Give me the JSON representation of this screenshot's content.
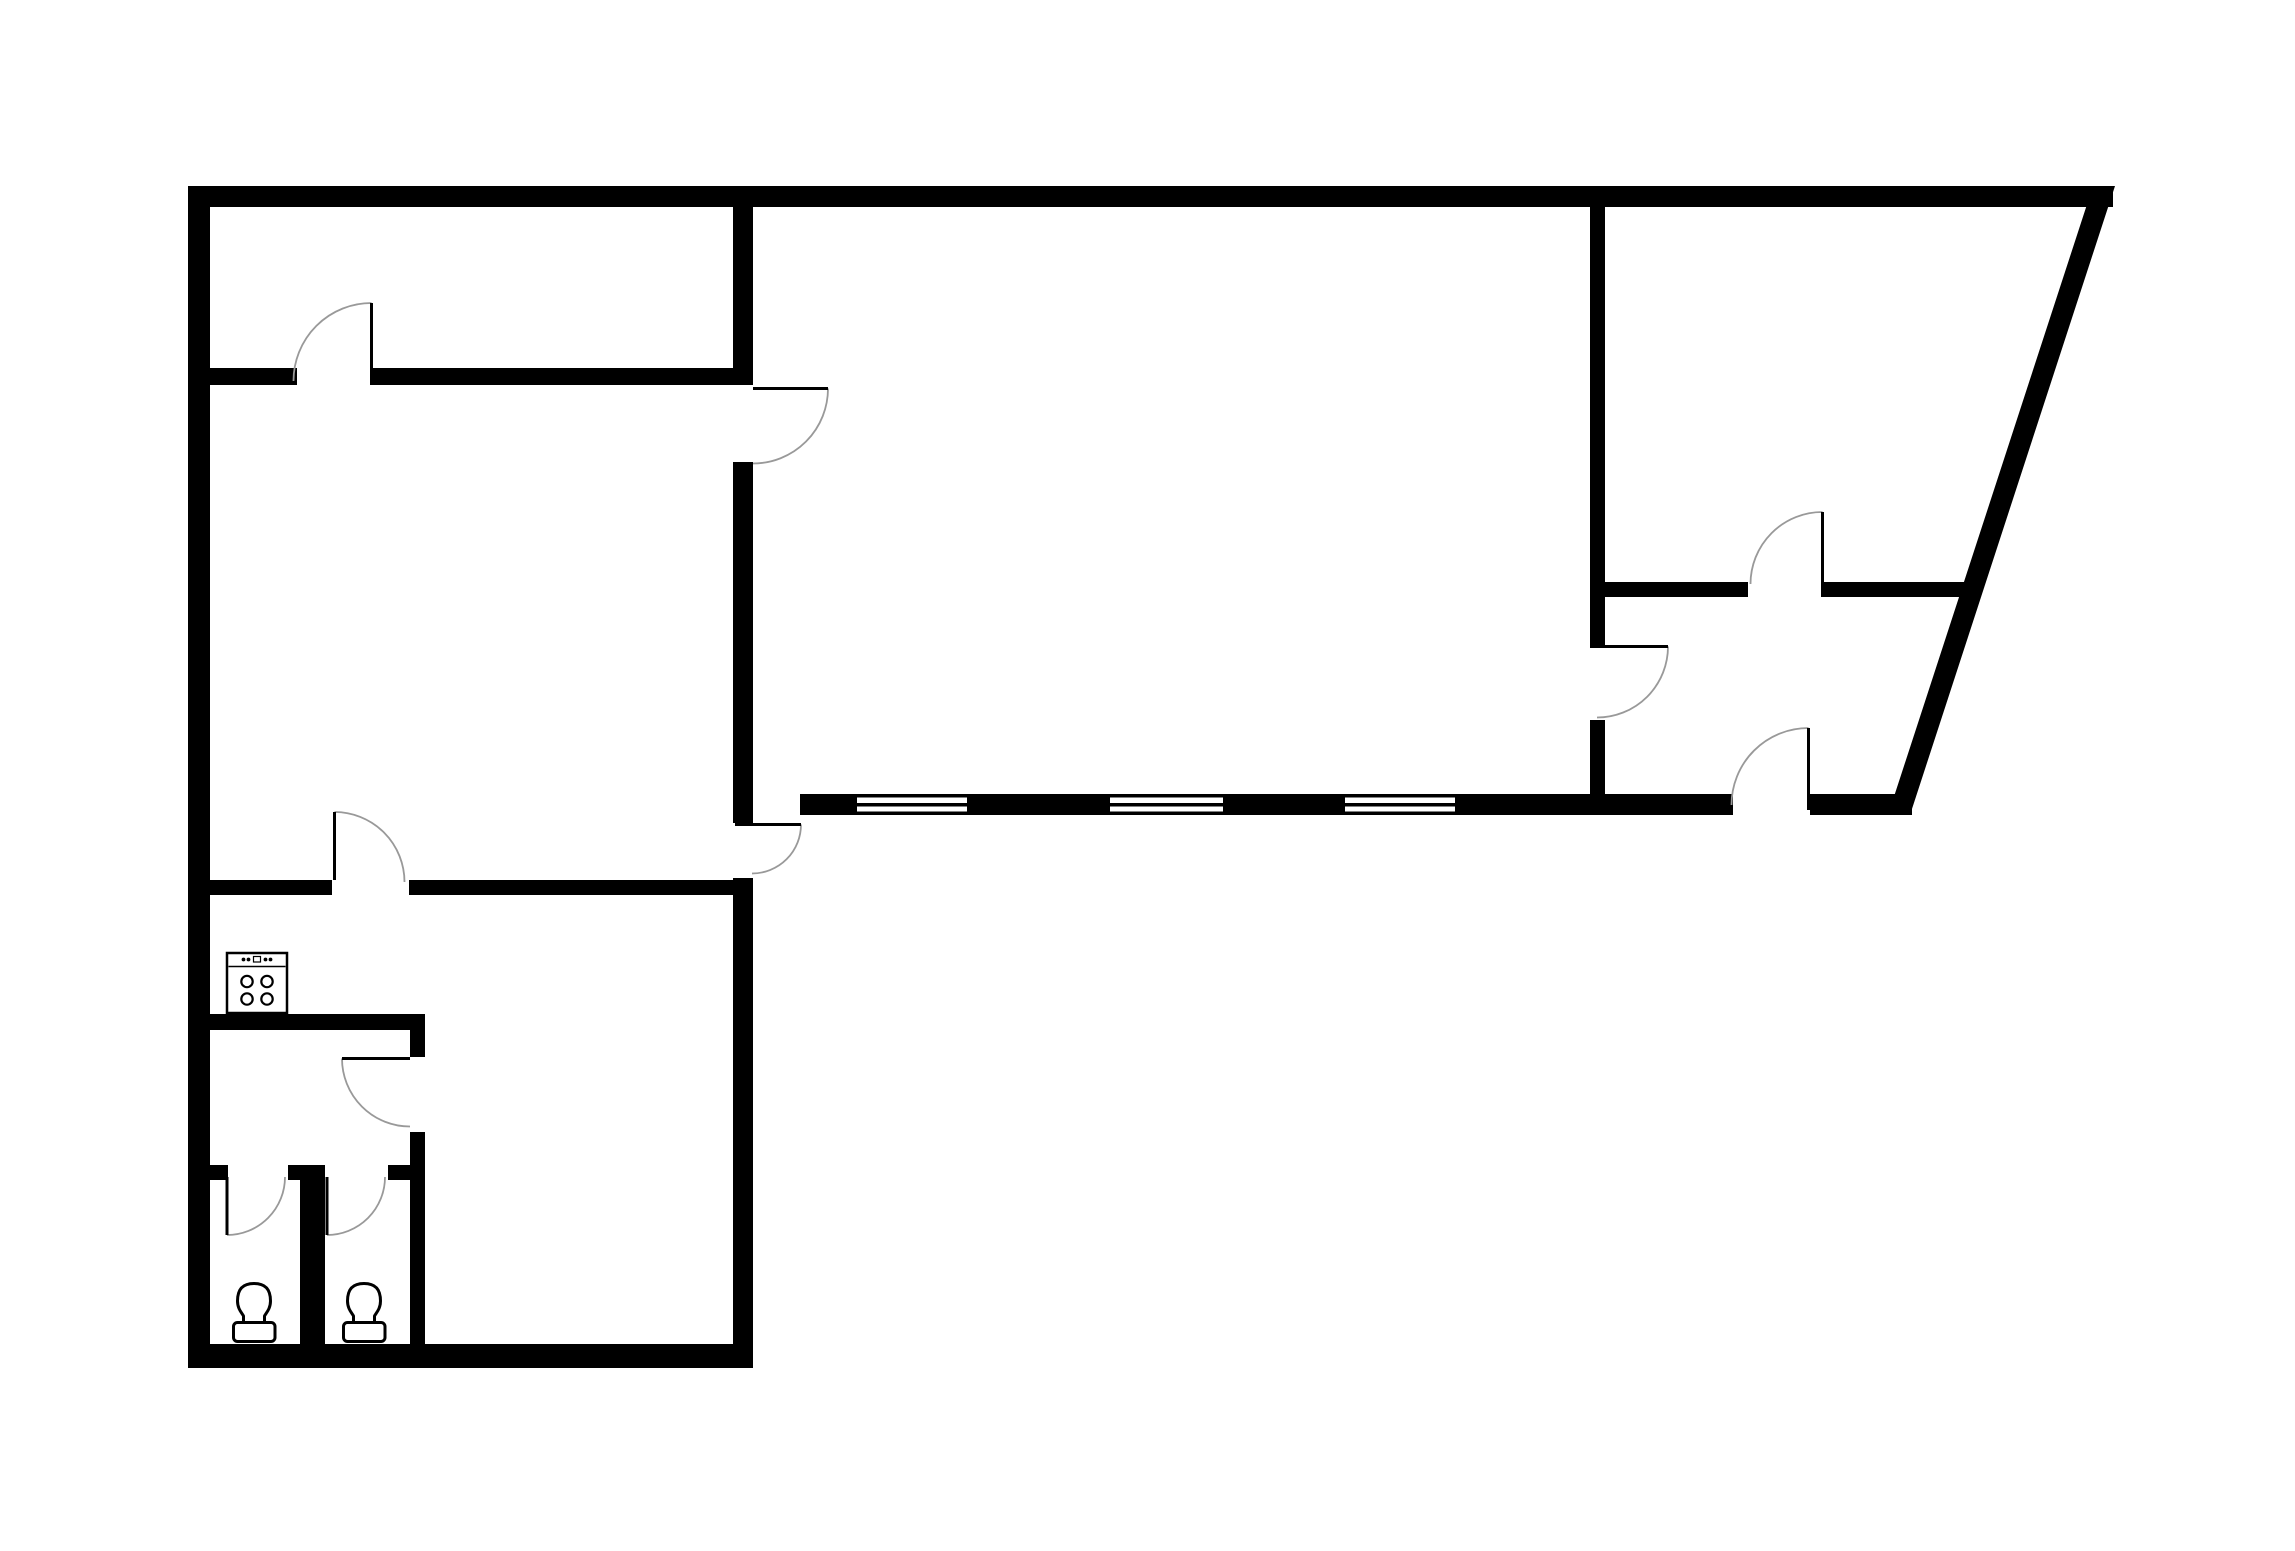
{
  "floorplan": {
    "description": "Black and white architectural floor plan with five rooms, ten swing doors, three windows, a stove and two toilets",
    "canvas": {
      "width": 2295,
      "height": 1551,
      "background": "#ffffff"
    },
    "colors": {
      "wall": "#000000",
      "door_arc": "#999999",
      "door_leaf": "#000000",
      "fixture_stroke": "#000000",
      "fixture_fill": "#ffffff"
    },
    "counts": {
      "doors": 10,
      "windows": 3,
      "toilets": 2,
      "stoves": 1
    },
    "shapes": [
      {
        "name": "wall-outer-top",
        "tag": "rect",
        "attrs": {
          "x": 188,
          "y": 186,
          "width": 1925,
          "height": 21,
          "fill": "#000000"
        }
      },
      {
        "name": "wall-outer-left",
        "tag": "rect",
        "attrs": {
          "x": 188,
          "y": 186,
          "width": 22,
          "height": 1182,
          "fill": "#000000"
        }
      },
      {
        "name": "wall-outer-bottom-left",
        "tag": "rect",
        "attrs": {
          "x": 188,
          "y": 1344,
          "width": 565,
          "height": 24,
          "fill": "#000000"
        }
      },
      {
        "name": "wall-outer-slanted",
        "tag": "polygon",
        "attrs": {
          "points": "2093,186 2115,186 1910,815 1888,815",
          "fill": "#000000"
        }
      },
      {
        "name": "wall-center-vertical-top",
        "tag": "rect",
        "attrs": {
          "x": 733,
          "y": 207,
          "width": 20,
          "height": 178,
          "fill": "#000000"
        }
      },
      {
        "name": "wall-center-vertical-mid",
        "tag": "rect",
        "attrs": {
          "x": 733,
          "y": 462,
          "width": 20,
          "height": 361,
          "fill": "#000000"
        }
      },
      {
        "name": "wall-center-vertical-low",
        "tag": "rect",
        "attrs": {
          "x": 733,
          "y": 878,
          "width": 20,
          "height": 466,
          "fill": "#000000"
        }
      },
      {
        "name": "wall-upperleft-divider-a",
        "tag": "rect",
        "attrs": {
          "x": 210,
          "y": 368,
          "width": 87,
          "height": 17,
          "fill": "#000000"
        }
      },
      {
        "name": "wall-upperleft-divider-b",
        "tag": "rect",
        "attrs": {
          "x": 372,
          "y": 368,
          "width": 361,
          "height": 17,
          "fill": "#000000"
        }
      },
      {
        "name": "wall-kitchen-top-a",
        "tag": "rect",
        "attrs": {
          "x": 210,
          "y": 880,
          "width": 122,
          "height": 15,
          "fill": "#000000"
        }
      },
      {
        "name": "wall-kitchen-top-b",
        "tag": "rect",
        "attrs": {
          "x": 409,
          "y": 880,
          "width": 324,
          "height": 15,
          "fill": "#000000"
        }
      },
      {
        "name": "wall-bath-top",
        "tag": "rect",
        "attrs": {
          "x": 210,
          "y": 1014,
          "width": 215,
          "height": 16,
          "fill": "#000000"
        }
      },
      {
        "name": "wall-bath-right-a",
        "tag": "rect",
        "attrs": {
          "x": 410,
          "y": 1030,
          "width": 15,
          "height": 27,
          "fill": "#000000"
        }
      },
      {
        "name": "wall-bath-right-b",
        "tag": "rect",
        "attrs": {
          "x": 410,
          "y": 1132,
          "width": 15,
          "height": 212,
          "fill": "#000000"
        }
      },
      {
        "name": "wall-stall-header-a",
        "tag": "rect",
        "attrs": {
          "x": 210,
          "y": 1165,
          "width": 18,
          "height": 15,
          "fill": "#000000"
        }
      },
      {
        "name": "wall-stall-header-b",
        "tag": "rect",
        "attrs": {
          "x": 288,
          "y": 1165,
          "width": 37,
          "height": 15,
          "fill": "#000000"
        }
      },
      {
        "name": "wall-stall-header-c",
        "tag": "rect",
        "attrs": {
          "x": 388,
          "y": 1165,
          "width": 22,
          "height": 15,
          "fill": "#000000"
        }
      },
      {
        "name": "wall-stall-middle",
        "tag": "rect",
        "attrs": {
          "x": 300,
          "y": 1180,
          "width": 25,
          "height": 164,
          "fill": "#000000"
        }
      },
      {
        "name": "wall-central-bottom-a",
        "tag": "rect",
        "attrs": {
          "x": 800,
          "y": 794,
          "width": 57,
          "height": 21,
          "fill": "#000000"
        }
      },
      {
        "name": "wall-central-bottom-b",
        "tag": "rect",
        "attrs": {
          "x": 967,
          "y": 794,
          "width": 143,
          "height": 21,
          "fill": "#000000"
        }
      },
      {
        "name": "wall-central-bottom-c",
        "tag": "rect",
        "attrs": {
          "x": 1223,
          "y": 794,
          "width": 122,
          "height": 21,
          "fill": "#000000"
        }
      },
      {
        "name": "wall-central-bottom-d",
        "tag": "rect",
        "attrs": {
          "x": 1455,
          "y": 794,
          "width": 278,
          "height": 21,
          "fill": "#000000"
        }
      },
      {
        "name": "wall-central-bottom-e",
        "tag": "rect",
        "attrs": {
          "x": 1810,
          "y": 794,
          "width": 102,
          "height": 21,
          "fill": "#000000"
        }
      },
      {
        "name": "wall-right-vertical-top",
        "tag": "rect",
        "attrs": {
          "x": 1590,
          "y": 207,
          "width": 15,
          "height": 438,
          "fill": "#000000"
        }
      },
      {
        "name": "wall-right-vertical-low",
        "tag": "rect",
        "attrs": {
          "x": 1590,
          "y": 720,
          "width": 15,
          "height": 95,
          "fill": "#000000"
        }
      },
      {
        "name": "wall-right-divider-a",
        "tag": "rect",
        "attrs": {
          "x": 1605,
          "y": 582,
          "width": 143,
          "height": 15,
          "fill": "#000000"
        }
      },
      {
        "name": "wall-right-divider-b",
        "tag": "rect",
        "attrs": {
          "x": 1823,
          "y": 582,
          "width": 152,
          "height": 15,
          "fill": "#000000"
        }
      },
      {
        "name": "window-1-top-edge",
        "tag": "rect",
        "attrs": {
          "x": 857,
          "y": 794,
          "width": 110,
          "height": 3.5,
          "fill": "#000000"
        }
      },
      {
        "name": "window-1-mid-line",
        "tag": "rect",
        "attrs": {
          "x": 857,
          "y": 803,
          "width": 110,
          "height": 3.5,
          "fill": "#000000"
        }
      },
      {
        "name": "window-1-bottom-edge",
        "tag": "rect",
        "attrs": {
          "x": 857,
          "y": 811.5,
          "width": 110,
          "height": 3.5,
          "fill": "#000000"
        }
      },
      {
        "name": "window-2-top-edge",
        "tag": "rect",
        "attrs": {
          "x": 1110,
          "y": 794,
          "width": 113,
          "height": 3.5,
          "fill": "#000000"
        }
      },
      {
        "name": "window-2-mid-line",
        "tag": "rect",
        "attrs": {
          "x": 1110,
          "y": 803,
          "width": 113,
          "height": 3.5,
          "fill": "#000000"
        }
      },
      {
        "name": "window-2-bottom-edge",
        "tag": "rect",
        "attrs": {
          "x": 1110,
          "y": 811.5,
          "width": 113,
          "height": 3.5,
          "fill": "#000000"
        }
      },
      {
        "name": "window-3-top-edge",
        "tag": "rect",
        "attrs": {
          "x": 1345,
          "y": 794,
          "width": 110,
          "height": 3.5,
          "fill": "#000000"
        }
      },
      {
        "name": "window-3-mid-line",
        "tag": "rect",
        "attrs": {
          "x": 1345,
          "y": 803,
          "width": 110,
          "height": 3.5,
          "fill": "#000000"
        }
      },
      {
        "name": "window-3-bottom-edge",
        "tag": "rect",
        "attrs": {
          "x": 1345,
          "y": 811.5,
          "width": 110,
          "height": 3.5,
          "fill": "#000000"
        }
      },
      {
        "name": "door-arc-upperleft-room",
        "tag": "path",
        "attrs": {
          "d": "M 371.5 303 A 78 78 0 0 0 293.5 381",
          "fill": "none",
          "stroke": "#999999",
          "stroke-width": 1.8
        }
      },
      {
        "name": "door-leaf-upperleft-room",
        "tag": "path",
        "attrs": {
          "d": "M 371.5 303 L 371.5 385",
          "fill": "none",
          "stroke": "#000000",
          "stroke-width": 3
        }
      },
      {
        "name": "door-arc-midleft-to-central",
        "tag": "path",
        "attrs": {
          "d": "M 828 388.5 A 75 75 0 0 1 753 463.5",
          "fill": "none",
          "stroke": "#999999",
          "stroke-width": 1.8
        }
      },
      {
        "name": "door-leaf-midleft-to-central",
        "tag": "path",
        "attrs": {
          "d": "M 753 388.5 L 828 388.5",
          "fill": "none",
          "stroke": "#000000",
          "stroke-width": 3
        }
      },
      {
        "name": "door-arc-corner-lowerleft",
        "tag": "path",
        "attrs": {
          "d": "M 801 824.5 A 49 49 0 0 1 752 873.5",
          "fill": "none",
          "stroke": "#999999",
          "stroke-width": 1.8
        }
      },
      {
        "name": "door-leaf-corner-lowerleft",
        "tag": "path",
        "attrs": {
          "d": "M 735 824.5 L 801 824.5",
          "fill": "none",
          "stroke": "#000000",
          "stroke-width": 3
        }
      },
      {
        "name": "door-arc-kitchen",
        "tag": "path",
        "attrs": {
          "d": "M 334.5 812 A 70 70 0 0 1 404.5 882",
          "fill": "none",
          "stroke": "#999999",
          "stroke-width": 1.8
        }
      },
      {
        "name": "door-leaf-kitchen",
        "tag": "path",
        "attrs": {
          "d": "M 334.5 812 L 334.5 880",
          "fill": "none",
          "stroke": "#000000",
          "stroke-width": 3
        }
      },
      {
        "name": "door-arc-bath-vestibule",
        "tag": "path",
        "attrs": {
          "d": "M 342 1058.5 A 68 68 0 0 0 410 1126.5",
          "fill": "none",
          "stroke": "#999999",
          "stroke-width": 1.8
        }
      },
      {
        "name": "door-leaf-bath-vestibule",
        "tag": "path",
        "attrs": {
          "d": "M 342 1058.5 L 410 1058.5",
          "fill": "none",
          "stroke": "#000000",
          "stroke-width": 3
        }
      },
      {
        "name": "door-arc-toilet-stall-1",
        "tag": "path",
        "attrs": {
          "d": "M 227 1235 A 58 58 0 0 0 285 1177",
          "fill": "none",
          "stroke": "#999999",
          "stroke-width": 1.8
        }
      },
      {
        "name": "door-leaf-toilet-stall-1",
        "tag": "path",
        "attrs": {
          "d": "M 227 1177 L 227 1235",
          "fill": "none",
          "stroke": "#000000",
          "stroke-width": 3
        }
      },
      {
        "name": "door-arc-toilet-stall-2",
        "tag": "path",
        "attrs": {
          "d": "M 327 1235 A 58 58 0 0 0 385 1177",
          "fill": "none",
          "stroke": "#999999",
          "stroke-width": 1.8
        }
      },
      {
        "name": "door-leaf-toilet-stall-2",
        "tag": "path",
        "attrs": {
          "d": "M 327 1177 L 327 1235",
          "fill": "none",
          "stroke": "#000000",
          "stroke-width": 3
        }
      },
      {
        "name": "door-arc-central-to-right",
        "tag": "path",
        "attrs": {
          "d": "M 1668 646.5 A 71 71 0 0 1 1597 717.5",
          "fill": "none",
          "stroke": "#999999",
          "stroke-width": 1.8
        }
      },
      {
        "name": "door-leaf-central-to-right",
        "tag": "path",
        "attrs": {
          "d": "M 1590 646.5 L 1668 646.5",
          "fill": "none",
          "stroke": "#000000",
          "stroke-width": 3
        }
      },
      {
        "name": "door-arc-right-divider",
        "tag": "path",
        "attrs": {
          "d": "M 1822.5 512 A 72 72 0 0 0 1750.5 584",
          "fill": "none",
          "stroke": "#999999",
          "stroke-width": 1.8
        }
      },
      {
        "name": "door-leaf-right-divider",
        "tag": "path",
        "attrs": {
          "d": "M 1822.5 512 L 1822.5 597",
          "fill": "none",
          "stroke": "#000000",
          "stroke-width": 3
        }
      },
      {
        "name": "door-arc-bottom-entrance",
        "tag": "path",
        "attrs": {
          "d": "M 1808.5 728 A 77 77 0 0 0 1731.5 805",
          "fill": "none",
          "stroke": "#999999",
          "stroke-width": 1.8
        }
      },
      {
        "name": "door-leaf-bottom-entrance",
        "tag": "path",
        "attrs": {
          "d": "M 1808.5 728 L 1808.5 810",
          "fill": "none",
          "stroke": "#000000",
          "stroke-width": 3
        }
      },
      {
        "name": "stove-icon-body",
        "tag": "rect",
        "attrs": {
          "x": 227,
          "y": 953,
          "width": 60,
          "height": 60,
          "fill": "#ffffff",
          "stroke": "#000000",
          "stroke-width": 2.5
        }
      },
      {
        "name": "stove-icon-panel-line",
        "tag": "path",
        "attrs": {
          "d": "M 228.5 966.5 L 285.5 966.5",
          "fill": "none",
          "stroke": "#000000",
          "stroke-width": 1.6
        }
      },
      {
        "name": "stove-icon-knob-1",
        "tag": "circle",
        "attrs": {
          "cx": 243.5,
          "cy": 959.5,
          "r": 1.9,
          "fill": "#000000"
        }
      },
      {
        "name": "stove-icon-knob-2",
        "tag": "circle",
        "attrs": {
          "cx": 248.5,
          "cy": 959.5,
          "r": 1.9,
          "fill": "#000000"
        }
      },
      {
        "name": "stove-icon-knob-switch",
        "tag": "rect",
        "attrs": {
          "x": 253.5,
          "y": 956.5,
          "width": 7,
          "height": 5.5,
          "fill": "#ffffff",
          "stroke": "#000000",
          "stroke-width": 1.2
        }
      },
      {
        "name": "stove-icon-knob-3",
        "tag": "circle",
        "attrs": {
          "cx": 265.5,
          "cy": 959.5,
          "r": 1.9,
          "fill": "#000000"
        }
      },
      {
        "name": "stove-icon-knob-4",
        "tag": "circle",
        "attrs": {
          "cx": 270.5,
          "cy": 959.5,
          "r": 1.9,
          "fill": "#000000"
        }
      },
      {
        "name": "stove-icon-burner-1",
        "tag": "circle",
        "attrs": {
          "cx": 247,
          "cy": 981.5,
          "r": 5.7,
          "fill": "#ffffff",
          "stroke": "#000000",
          "stroke-width": 2.2
        }
      },
      {
        "name": "stove-icon-burner-2",
        "tag": "circle",
        "attrs": {
          "cx": 267,
          "cy": 981.5,
          "r": 5.7,
          "fill": "#ffffff",
          "stroke": "#000000",
          "stroke-width": 2.2
        }
      },
      {
        "name": "stove-icon-burner-3",
        "tag": "circle",
        "attrs": {
          "cx": 247,
          "cy": 999,
          "r": 5.7,
          "fill": "#ffffff",
          "stroke": "#000000",
          "stroke-width": 2.2
        }
      },
      {
        "name": "stove-icon-burner-4",
        "tag": "circle",
        "attrs": {
          "cx": 267,
          "cy": 999,
          "r": 5.7,
          "fill": "#ffffff",
          "stroke": "#000000",
          "stroke-width": 2.2
        }
      },
      {
        "name": "toilet-icon-1-bowl",
        "tag": "path",
        "attrs": {
          "d": "M 237.5 1301 C 237.5 1289 243 1283.5 254 1283.5 C 265 1283.5 270.5 1289 270.5 1301 C 270.5 1309 266 1313 264.5 1316 L 264.5 1322.5 L 243.5 1322.5 L 243.5 1316 C 242 1313 237.5 1309 237.5 1301 Z",
          "fill": "#ffffff",
          "stroke": "#000000",
          "stroke-width": 3,
          "stroke-linejoin": "round"
        }
      },
      {
        "name": "toilet-icon-1-tank",
        "tag": "rect",
        "attrs": {
          "x": 233.5,
          "y": 1322.5,
          "width": 41.5,
          "height": 19,
          "rx": 4,
          "fill": "#ffffff",
          "stroke": "#000000",
          "stroke-width": 3
        }
      },
      {
        "name": "toilet-icon-2-bowl",
        "tag": "path",
        "attrs": {
          "d": "M 347.5 1301 C 347.5 1289 353 1283.5 364 1283.5 C 375 1283.5 380.5 1289 380.5 1301 C 380.5 1309 376 1313 374.5 1316 L 374.5 1322.5 L 353.5 1322.5 L 353.5 1316 C 352 1313 347.5 1309 347.5 1301 Z",
          "fill": "#ffffff",
          "stroke": "#000000",
          "stroke-width": 3,
          "stroke-linejoin": "round"
        }
      },
      {
        "name": "toilet-icon-2-tank",
        "tag": "rect",
        "attrs": {
          "x": 343.5,
          "y": 1322.5,
          "width": 41.5,
          "height": 19,
          "rx": 4,
          "fill": "#ffffff",
          "stroke": "#000000",
          "stroke-width": 3
        }
      }
    ]
  }
}
